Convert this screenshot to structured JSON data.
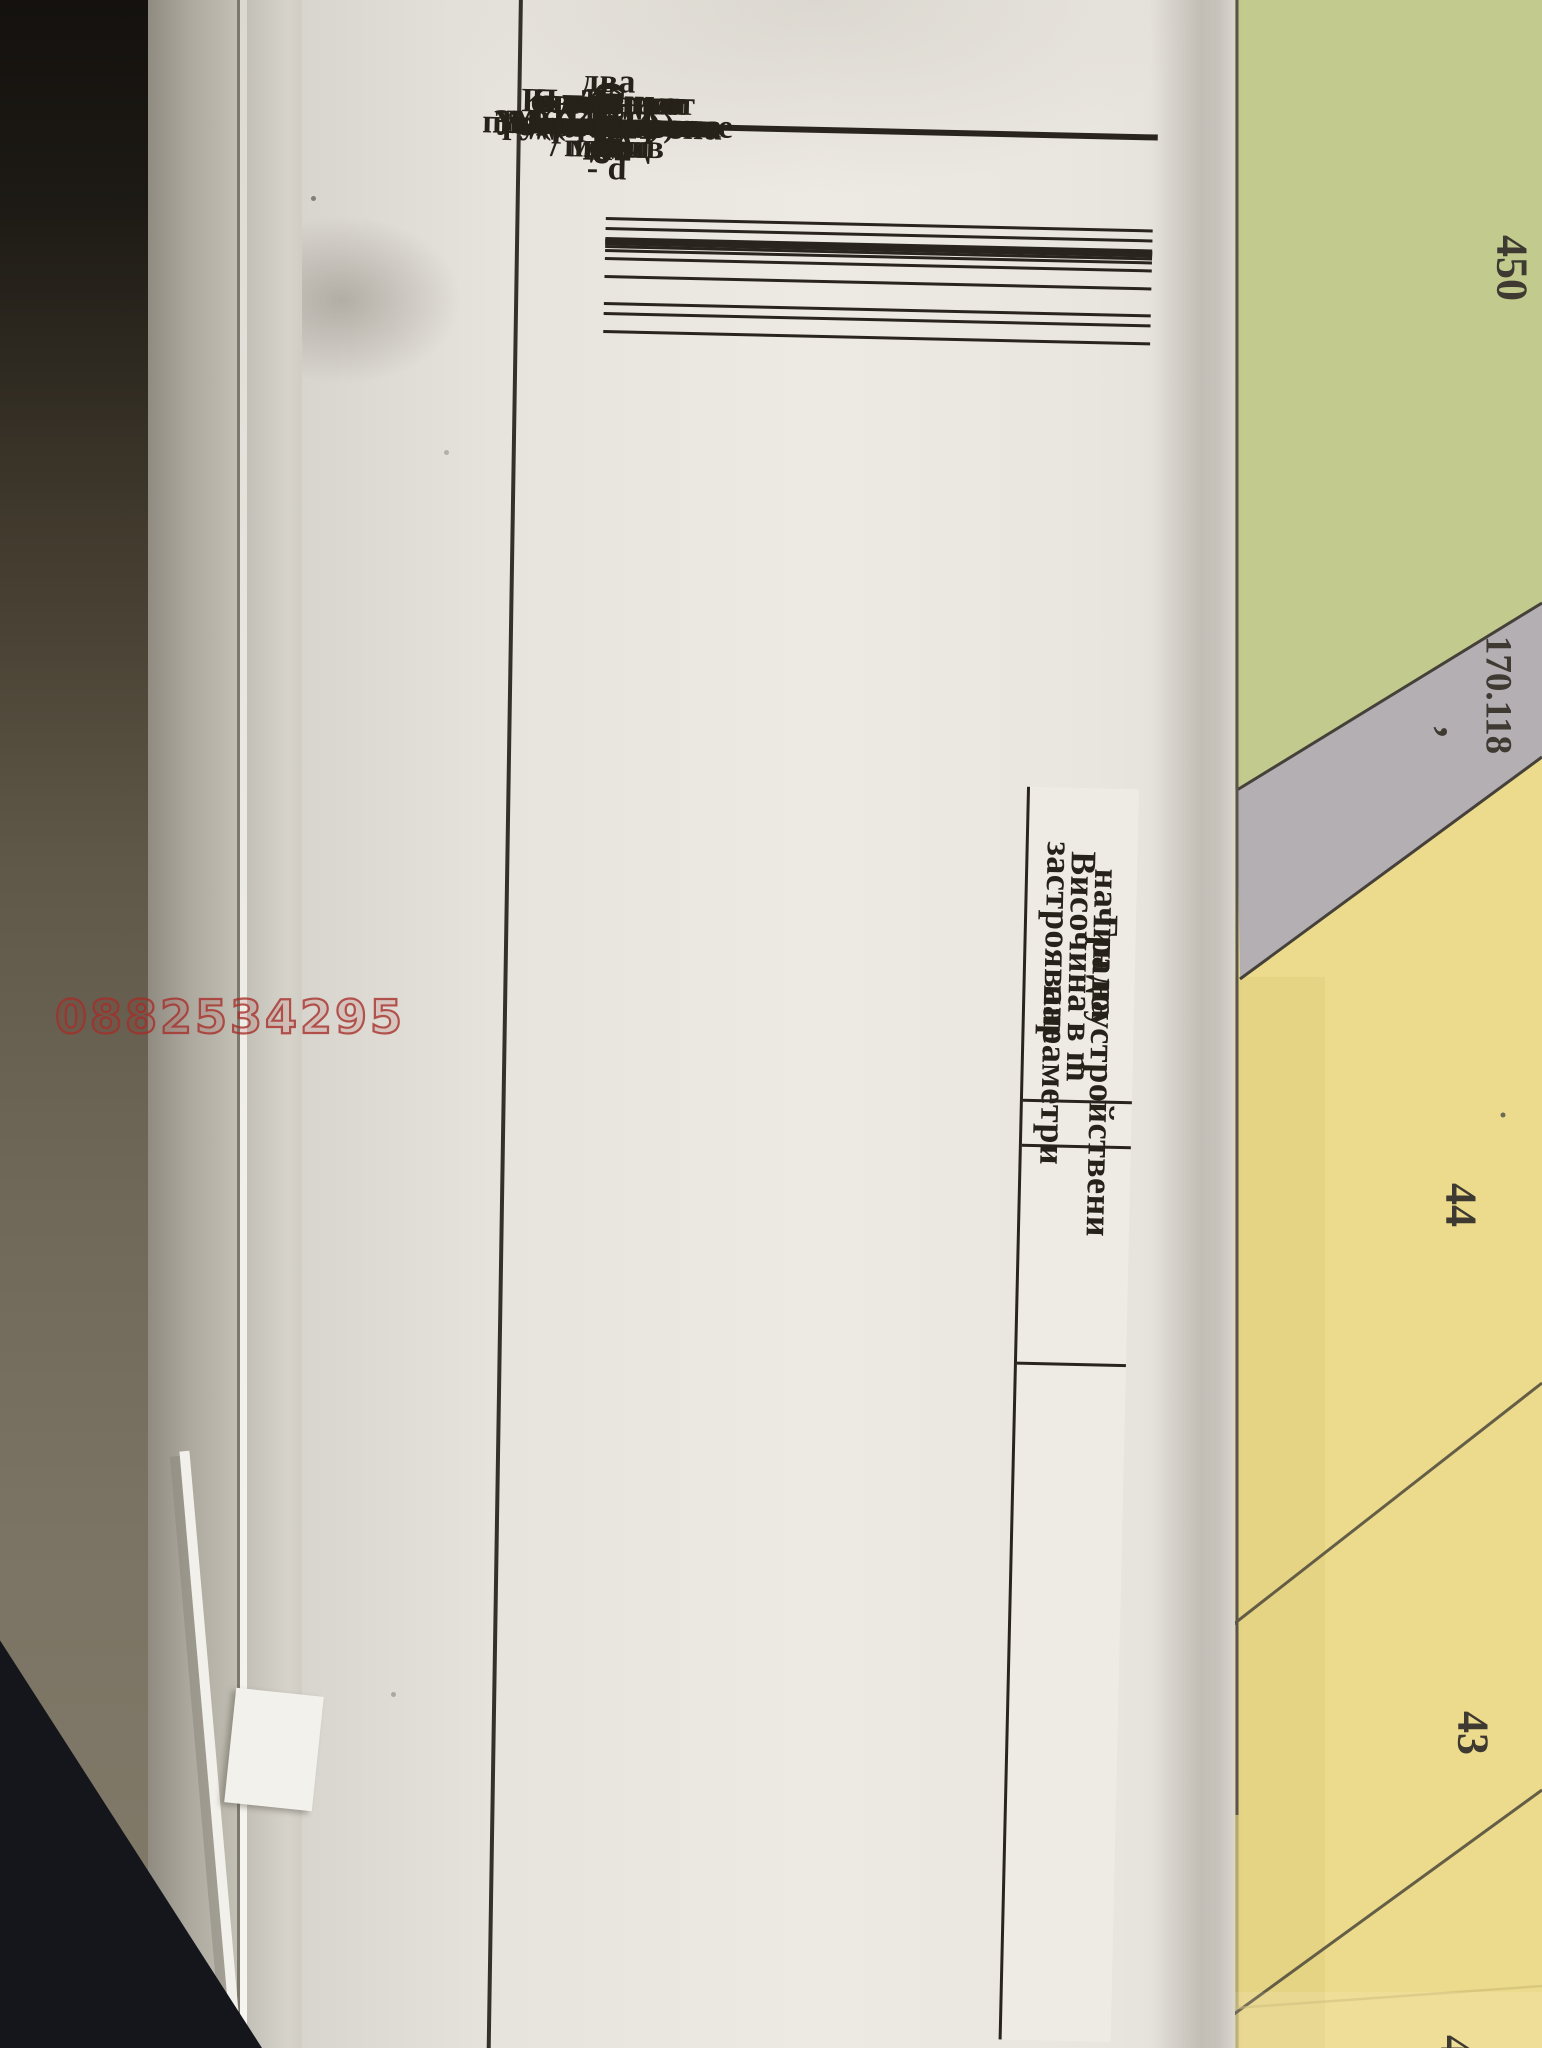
{
  "watermark": "0882534295",
  "table": {
    "rows": [
      {
        "value": "",
        "lines": [
          "квартал / масив"
        ]
      },
      {
        "value": "",
        "lines": [
          "УПИ"
        ]
      },
      {
        "value": "478",
        "lines": [
          "площ  m2"
        ]
      },
      {
        "value": "Жм",
        "lines": [
          "Устройствена",
          "зона"
        ]
      },
      {
        "value": "—",
        "lines": [
          "установено",
          "предназначение"
        ]
      },
      {
        "value": "",
        "lines": [
          "Задължителна"
        ]
      },
      {
        "value": "≤10",
        "lines": [
          "Максимална"
        ]
      },
      {
        "value": "",
        "lines": [
          "Възможна",
          "от-до"
        ]
      },
      {
        "value": "60%",
        "lines": [
          "Плътност на",
          "застрояване",
          "(Пзастр)"
        ]
      },
      {
        "value": "1.2",
        "lines": [
          "Коефицент на",
          "интензивност",
          "(Кинт)"
        ]
      },
      {
        "value": "40%",
        "lines": [
          "Минимална",
          "озеленена площ"
        ]
      },
      {
        "value": "●",
        "lines": [
          "свободно - е"
        ]
      },
      {
        "value": "",
        "lines": [
          "свързано в",
          "два имота - d"
        ]
      },
      {
        "value": "",
        "lines": [
          "свързано - с"
        ]
      }
    ],
    "groups": [
      {
        "lines": [
          "Височина в m"
        ]
      },
      {
        "lines": [
          "Градоустройствени",
          "параметри"
        ]
      },
      {
        "lines": [
          "начин на",
          "застрояване"
        ]
      }
    ]
  },
  "map": {
    "parcel_450": "450",
    "road_id": "170.118",
    "road_tick": ",",
    "parcel_44": "44",
    "parcel_43": "43",
    "parcel_partial": "4",
    "colors": {
      "green_zone": "#c3ca8e",
      "road_gray": "#b4afb3",
      "yellow_zone": "#ecdb8c",
      "ink": "#262119",
      "watermark_red": "#a62d28"
    }
  }
}
